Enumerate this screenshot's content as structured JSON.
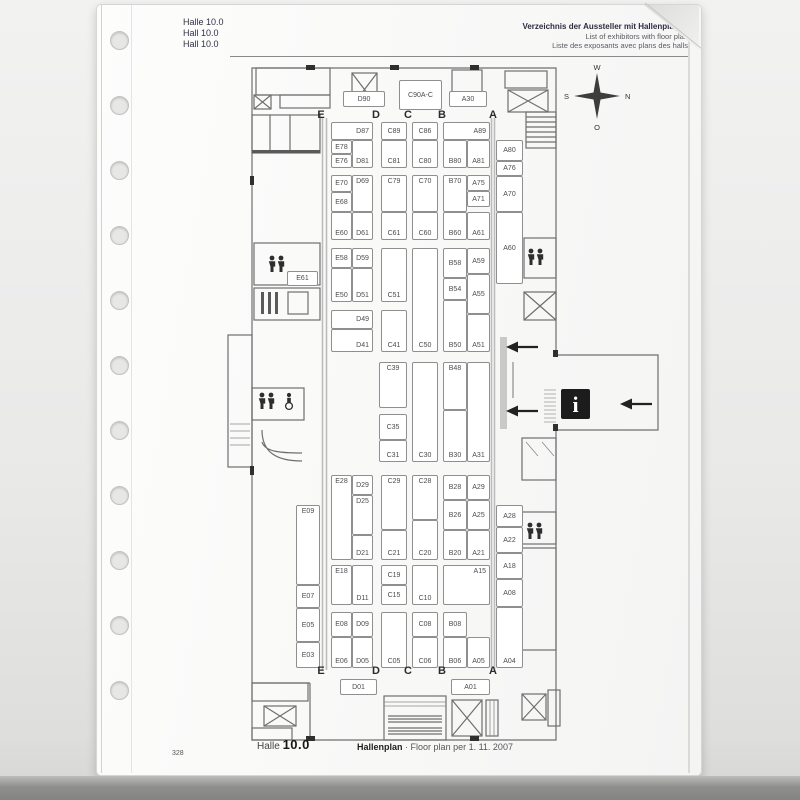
{
  "sleeve": {
    "hole_count": 11
  },
  "header": {
    "left_lines": [
      "Halle 10.0",
      "Hall 10.0",
      "Hall 10.0"
    ],
    "right_lines": [
      "Verzeichnis der Aussteller mit Hallenplänen",
      "List of exhibitors with floor plan",
      "Liste des exposants avec plans des halls"
    ]
  },
  "compass": {
    "top": "W",
    "right": "N",
    "bottom": "O",
    "left": "S"
  },
  "footer": {
    "hall_word": "Halle",
    "hall_number": "10.0",
    "plan_title": "Hallenplan",
    "separator": "·",
    "plan_subtitle": "Floor plan per 1. 11. 2007",
    "page_number": "328"
  },
  "icons": {
    "compass": "compass-rose",
    "restroom": "male-female-figures",
    "accessible": "wheelchair",
    "stairs": "crossed-box",
    "info": "letter-i-on-black",
    "direction": "left-arrow"
  },
  "plan": {
    "column_letters": [
      "E",
      "D",
      "C",
      "B",
      "A"
    ],
    "column_letter_x": [
      321,
      376,
      408,
      442,
      493
    ],
    "letter_rows": {
      "top": 109,
      "bottom": 665
    },
    "booths": [
      {
        "l": "D90",
        "x": 343,
        "y": 91,
        "w": 42,
        "h": 16
      },
      {
        "l": "C90A-C",
        "x": 399,
        "y": 80,
        "w": 43,
        "h": 30
      },
      {
        "l": "A30",
        "x": 449,
        "y": 91,
        "w": 38,
        "h": 16
      },
      {
        "l": "D87",
        "x": 331,
        "y": 122,
        "w": 42,
        "h": 18,
        "ha": "right"
      },
      {
        "l": "E78",
        "x": 331,
        "y": 140,
        "w": 21,
        "h": 14
      },
      {
        "l": "E76",
        "x": 331,
        "y": 154,
        "w": 21,
        "h": 14
      },
      {
        "l": "D81",
        "x": 352,
        "y": 140,
        "w": 21,
        "h": 28,
        "va": "bottom"
      },
      {
        "l": "C89",
        "x": 381,
        "y": 122,
        "w": 26,
        "h": 18
      },
      {
        "l": "C81",
        "x": 381,
        "y": 140,
        "w": 26,
        "h": 28,
        "va": "bottom"
      },
      {
        "l": "C86",
        "x": 412,
        "y": 122,
        "w": 26,
        "h": 18
      },
      {
        "l": "C80",
        "x": 412,
        "y": 140,
        "w": 26,
        "h": 28,
        "va": "bottom"
      },
      {
        "l": "A89",
        "x": 443,
        "y": 122,
        "w": 47,
        "h": 18,
        "ha": "right"
      },
      {
        "l": "B80",
        "x": 443,
        "y": 140,
        "w": 24,
        "h": 28,
        "va": "bottom"
      },
      {
        "l": "A81",
        "x": 467,
        "y": 140,
        "w": 23,
        "h": 28,
        "va": "bottom"
      },
      {
        "l": "A80",
        "x": 496,
        "y": 140,
        "w": 27,
        "h": 21
      },
      {
        "l": "A76",
        "x": 496,
        "y": 161,
        "w": 27,
        "h": 15
      },
      {
        "l": "A70",
        "x": 496,
        "y": 176,
        "w": 27,
        "h": 36
      },
      {
        "l": "A60",
        "x": 496,
        "y": 212,
        "w": 27,
        "h": 72
      },
      {
        "l": "E70",
        "x": 331,
        "y": 175,
        "w": 21,
        "h": 17
      },
      {
        "l": "E68",
        "x": 331,
        "y": 192,
        "w": 21,
        "h": 20
      },
      {
        "l": "D69",
        "x": 352,
        "y": 175,
        "w": 21,
        "h": 37,
        "va": "top"
      },
      {
        "l": "E60",
        "x": 331,
        "y": 212,
        "w": 21,
        "h": 28,
        "va": "bottom"
      },
      {
        "l": "D61",
        "x": 352,
        "y": 212,
        "w": 21,
        "h": 28,
        "va": "bottom"
      },
      {
        "l": "C79",
        "x": 381,
        "y": 175,
        "w": 26,
        "h": 37,
        "va": "top"
      },
      {
        "l": "C61",
        "x": 381,
        "y": 212,
        "w": 26,
        "h": 28,
        "va": "bottom"
      },
      {
        "l": "C70",
        "x": 412,
        "y": 175,
        "w": 26,
        "h": 37,
        "va": "top"
      },
      {
        "l": "C60",
        "x": 412,
        "y": 212,
        "w": 26,
        "h": 28,
        "va": "bottom"
      },
      {
        "l": "B70",
        "x": 443,
        "y": 175,
        "w": 24,
        "h": 37,
        "va": "top"
      },
      {
        "l": "A75",
        "x": 467,
        "y": 175,
        "w": 23,
        "h": 16
      },
      {
        "l": "A71",
        "x": 467,
        "y": 191,
        "w": 23,
        "h": 16
      },
      {
        "l": "B60",
        "x": 443,
        "y": 212,
        "w": 24,
        "h": 28,
        "va": "bottom"
      },
      {
        "l": "A61",
        "x": 467,
        "y": 212,
        "w": 23,
        "h": 28,
        "va": "bottom"
      },
      {
        "l": "E58",
        "x": 331,
        "y": 248,
        "w": 21,
        "h": 20
      },
      {
        "l": "D59",
        "x": 352,
        "y": 248,
        "w": 21,
        "h": 20
      },
      {
        "l": "E50",
        "x": 331,
        "y": 268,
        "w": 21,
        "h": 34,
        "va": "bottom"
      },
      {
        "l": "D51",
        "x": 352,
        "y": 268,
        "w": 21,
        "h": 34,
        "va": "bottom"
      },
      {
        "l": "C51",
        "x": 381,
        "y": 248,
        "w": 26,
        "h": 54,
        "va": "bottom"
      },
      {
        "l": "C50",
        "x": 412,
        "y": 248,
        "w": 26,
        "h": 104,
        "va": "bottom"
      },
      {
        "l": "B58",
        "x": 443,
        "y": 248,
        "w": 24,
        "h": 30
      },
      {
        "l": "A59",
        "x": 467,
        "y": 248,
        "w": 23,
        "h": 26
      },
      {
        "l": "B54",
        "x": 443,
        "y": 278,
        "w": 24,
        "h": 22
      },
      {
        "l": "A55",
        "x": 467,
        "y": 274,
        "w": 23,
        "h": 40
      },
      {
        "l": "B50",
        "x": 443,
        "y": 300,
        "w": 24,
        "h": 52,
        "va": "bottom"
      },
      {
        "l": "A51",
        "x": 467,
        "y": 314,
        "w": 23,
        "h": 38,
        "va": "bottom"
      },
      {
        "l": "D49",
        "x": 331,
        "y": 310,
        "w": 42,
        "h": 19,
        "ha": "right"
      },
      {
        "l": "D41",
        "x": 331,
        "y": 329,
        "w": 42,
        "h": 23,
        "va": "bottom",
        "ha": "right"
      },
      {
        "l": "C41",
        "x": 381,
        "y": 310,
        "w": 26,
        "h": 42,
        "va": "bottom"
      },
      {
        "l": "C39",
        "x": 379,
        "y": 362,
        "w": 28,
        "h": 46,
        "va": "top"
      },
      {
        "l": "C35",
        "x": 379,
        "y": 414,
        "w": 28,
        "h": 26
      },
      {
        "l": "C31",
        "x": 379,
        "y": 440,
        "w": 28,
        "h": 22,
        "va": "bottom"
      },
      {
        "l": "C30",
        "x": 412,
        "y": 362,
        "w": 26,
        "h": 100,
        "va": "bottom"
      },
      {
        "l": "B48",
        "x": 443,
        "y": 362,
        "w": 24,
        "h": 48,
        "va": "top"
      },
      {
        "l": "B30",
        "x": 443,
        "y": 410,
        "w": 24,
        "h": 52,
        "va": "bottom"
      },
      {
        "l": "A31",
        "x": 467,
        "y": 362,
        "w": 23,
        "h": 100,
        "va": "bottom"
      },
      {
        "l": "E28",
        "x": 331,
        "y": 475,
        "w": 21,
        "h": 85,
        "va": "top"
      },
      {
        "l": "D29",
        "x": 352,
        "y": 475,
        "w": 21,
        "h": 20
      },
      {
        "l": "D25",
        "x": 352,
        "y": 495,
        "w": 21,
        "h": 40,
        "va": "top"
      },
      {
        "l": "D21",
        "x": 352,
        "y": 535,
        "w": 21,
        "h": 25,
        "va": "bottom"
      },
      {
        "l": "C29",
        "x": 381,
        "y": 475,
        "w": 26,
        "h": 55,
        "va": "top"
      },
      {
        "l": "C21",
        "x": 381,
        "y": 530,
        "w": 26,
        "h": 30,
        "va": "bottom"
      },
      {
        "l": "C28",
        "x": 412,
        "y": 475,
        "w": 26,
        "h": 45,
        "va": "top"
      },
      {
        "l": "C20",
        "x": 412,
        "y": 520,
        "w": 26,
        "h": 40,
        "va": "bottom"
      },
      {
        "l": "B28",
        "x": 443,
        "y": 475,
        "w": 24,
        "h": 25
      },
      {
        "l": "A29",
        "x": 467,
        "y": 475,
        "w": 23,
        "h": 25
      },
      {
        "l": "B26",
        "x": 443,
        "y": 500,
        "w": 24,
        "h": 30
      },
      {
        "l": "A25",
        "x": 467,
        "y": 500,
        "w": 23,
        "h": 30
      },
      {
        "l": "B20",
        "x": 443,
        "y": 530,
        "w": 24,
        "h": 30,
        "va": "bottom"
      },
      {
        "l": "A21",
        "x": 467,
        "y": 530,
        "w": 23,
        "h": 30,
        "va": "bottom"
      },
      {
        "l": "A28",
        "x": 496,
        "y": 505,
        "w": 27,
        "h": 22
      },
      {
        "l": "A22",
        "x": 496,
        "y": 527,
        "w": 27,
        "h": 26
      },
      {
        "l": "A18",
        "x": 496,
        "y": 553,
        "w": 27,
        "h": 26
      },
      {
        "l": "A08",
        "x": 496,
        "y": 579,
        "w": 27,
        "h": 28
      },
      {
        "l": "A04",
        "x": 496,
        "y": 607,
        "w": 27,
        "h": 61,
        "va": "bottom"
      },
      {
        "l": "E18",
        "x": 331,
        "y": 565,
        "w": 21,
        "h": 40,
        "va": "top"
      },
      {
        "l": "D11",
        "x": 352,
        "y": 565,
        "w": 21,
        "h": 40,
        "va": "bottom"
      },
      {
        "l": "C19",
        "x": 381,
        "y": 565,
        "w": 26,
        "h": 20
      },
      {
        "l": "C15",
        "x": 381,
        "y": 585,
        "w": 26,
        "h": 20
      },
      {
        "l": "C10",
        "x": 412,
        "y": 565,
        "w": 26,
        "h": 40,
        "va": "bottom"
      },
      {
        "l": "A15",
        "x": 443,
        "y": 565,
        "w": 47,
        "h": 40,
        "va": "top",
        "ha": "right"
      },
      {
        "l": "E08",
        "x": 331,
        "y": 612,
        "w": 21,
        "h": 25
      },
      {
        "l": "D09",
        "x": 352,
        "y": 612,
        "w": 21,
        "h": 25
      },
      {
        "l": "E06",
        "x": 331,
        "y": 637,
        "w": 21,
        "h": 31,
        "va": "bottom"
      },
      {
        "l": "D05",
        "x": 352,
        "y": 637,
        "w": 21,
        "h": 31,
        "va": "bottom"
      },
      {
        "l": "C05",
        "x": 381,
        "y": 612,
        "w": 26,
        "h": 56,
        "va": "bottom"
      },
      {
        "l": "C08",
        "x": 412,
        "y": 612,
        "w": 26,
        "h": 25
      },
      {
        "l": "C06",
        "x": 412,
        "y": 637,
        "w": 26,
        "h": 31,
        "va": "bottom"
      },
      {
        "l": "B08",
        "x": 443,
        "y": 612,
        "w": 24,
        "h": 25
      },
      {
        "l": "B06",
        "x": 443,
        "y": 637,
        "w": 24,
        "h": 31,
        "va": "bottom"
      },
      {
        "l": "A05",
        "x": 467,
        "y": 637,
        "w": 23,
        "h": 31,
        "va": "bottom"
      },
      {
        "l": "D01",
        "x": 340,
        "y": 679,
        "w": 37,
        "h": 16
      },
      {
        "l": "A01",
        "x": 451,
        "y": 679,
        "w": 39,
        "h": 16
      },
      {
        "l": "E09",
        "x": 296,
        "y": 505,
        "w": 24,
        "h": 80,
        "va": "top"
      },
      {
        "l": "E07",
        "x": 296,
        "y": 585,
        "w": 24,
        "h": 23
      },
      {
        "l": "E05",
        "x": 296,
        "y": 608,
        "w": 24,
        "h": 34
      },
      {
        "l": "E03",
        "x": 296,
        "y": 642,
        "w": 24,
        "h": 26
      },
      {
        "l": "E61",
        "x": 287,
        "y": 271,
        "w": 31,
        "h": 15
      }
    ]
  }
}
